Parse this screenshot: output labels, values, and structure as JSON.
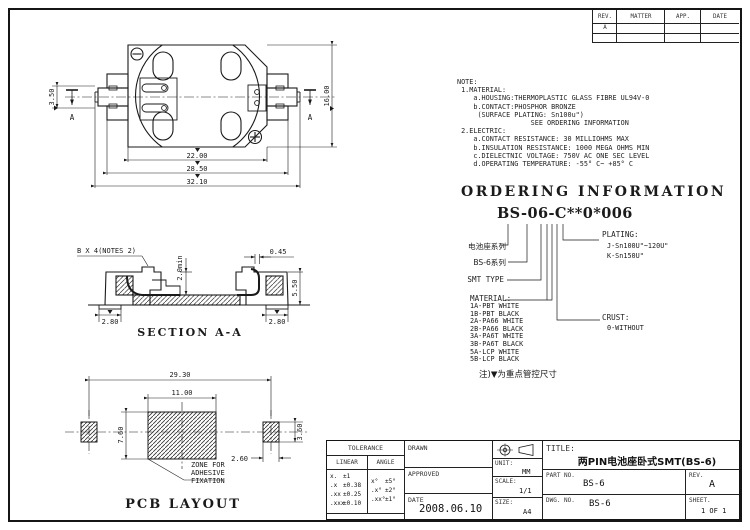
{
  "rev_table": {
    "headers": [
      "REV.",
      "MATTER",
      "APP.",
      "DATE"
    ],
    "row1_rev": "A"
  },
  "note_text": "NOTE:\n 1.MATERIAL:\n    a.HOUSING:THERMOPLASTIC GLASS FIBRE UL94V-0\n    b.CONTACT:PHOSPHOR BRONZE\n     (SURFACE PLATING: Sn100u\")\n                  SEE ORDERING INFORMATION\n 2.ELECTRIC:\n    a.CONTACT RESISTANCE: 30 MILLIOHMS MAX\n    b.INSULATION RESISTANCE: 1000 MEGA OHMS MIN\n    c.DIELECTNIC VOLTAGE: 750V AC ONE SEC LEVEL\n    d.OPERATING TEMPERATURE: -55° C~ +85° C",
  "ordering": {
    "heading": "ORDERING  INFORMATION",
    "part_code": "BS-06-C**0*006",
    "series_label": "电池座系列",
    "family_label": "BS-6系列",
    "smt_label": "SMT TYPE",
    "material_title": "MATERIAL:",
    "materials": [
      "1A-PBT WHITE",
      "1B-PBT BLACK",
      "2A-PA66 WHITE",
      "2B-PA66 BLACK",
      "3A-PA6T WHITE",
      "3B-PA6T BLACK",
      "5A-LCP WHITE",
      "5B-LCP BLACK"
    ],
    "plating_title": "PLATING:",
    "plating_j": "J-Sn100U\"~120U\"",
    "plating_k": "K-Sn150U\"",
    "crust_title": "CRUST:",
    "crust_option": "0-WITHOUT",
    "control_note": "注)▼为重点管控尺寸"
  },
  "top_view": {
    "dim_terminal": "3.50",
    "dim_height": "16.00",
    "dim_body": "22.00",
    "dim_tabs": "28.50",
    "dim_overall": "32.10",
    "section_letter_left": "A",
    "section_letter_right": "A",
    "minus": "−",
    "plus": "+"
  },
  "section_view": {
    "title": "SECTION A-A",
    "callout": "B X 4(NOTES 2)",
    "dim_thickness": "0.45",
    "dim_min": "2.0min",
    "dim_height": "5.50",
    "dim_pad_left": "2.80",
    "dim_pad_right": "2.80"
  },
  "pcb_view": {
    "title": "PCB LAYOUT",
    "dim_overall": "29.30",
    "dim_zone_w": "11.00",
    "dim_zone_h": "7.60",
    "dim_pad_h": "3.60",
    "dim_pad_w": "2.60",
    "zone_line1": "ZONE FOR",
    "zone_line2": "ADHESIVE",
    "zone_line3": "FIXATION"
  },
  "title_block": {
    "tolerance_title": "TOLERANCE",
    "linear_label": "LINEAR",
    "angle_label": "ANGLE",
    "lin": [
      [
        "x.",
        "±1"
      ],
      [
        ".x",
        "±0.38"
      ],
      [
        ".xx",
        "±0.25"
      ],
      [
        ".xxx",
        "±0.10"
      ]
    ],
    "ang": [
      [
        "x°",
        "±5°"
      ],
      [
        ".x°",
        "±2°"
      ],
      [
        ".xx°",
        "±1°"
      ]
    ],
    "drawn_label": "DRAWN",
    "approved_label": "APPROVED",
    "date_label": "DATE",
    "date_value": "2008.06.10",
    "unit_label": "UNIT:",
    "unit_value": "MM",
    "scale_label": "SCALE:",
    "scale_value": "1/1",
    "size_label": "SIZE:",
    "size_value": "A4",
    "title_label": "TITLE:",
    "title_value": "两PIN电池座卧式SMT(BS-6)",
    "part_no_label": "PART NO.",
    "part_no_value": "BS-6",
    "rev_label": "REV.",
    "rev_value": "A",
    "dwg_label": "DWG. NO.",
    "dwg_value": "BS-6",
    "sheet_label": "SHEET.",
    "sheet_value": "1 OF 1"
  }
}
